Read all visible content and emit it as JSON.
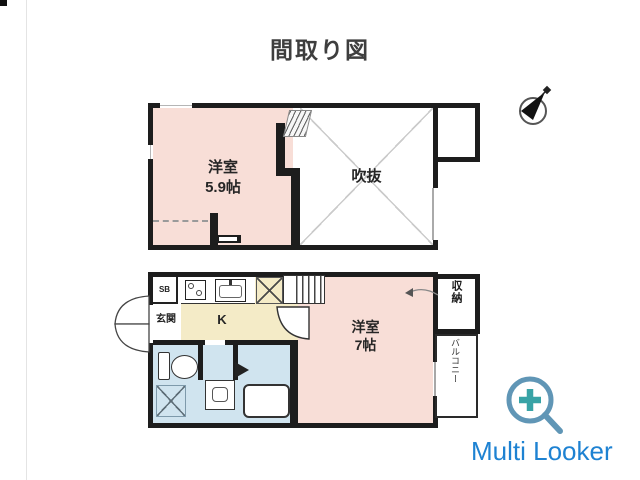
{
  "title": "間取り図",
  "floor2": {
    "room": {
      "name": "洋室",
      "size": "5.9帖"
    },
    "void_label": "吹抜"
  },
  "floor1": {
    "shoe_box": "SB",
    "entrance": "玄関",
    "kitchen": "K",
    "room": {
      "name": "洋室",
      "size": "7帖"
    },
    "storage": "収納",
    "balcony": "バルコニー"
  },
  "watermark": {
    "text": "Multi Looker",
    "color": "#1e82d2"
  },
  "icons": {
    "compass": "north-compass-icon",
    "magnifier": "zoom-plus-icon",
    "stairs": "stairs",
    "doors": "door-swing-arc"
  },
  "colors": {
    "wall": "#1d1d1d",
    "western_room": "#f8ded7",
    "kitchen": "#f4ebc7",
    "sanitary": "#d0e4ef",
    "void_cross": "#cbcbcb"
  }
}
